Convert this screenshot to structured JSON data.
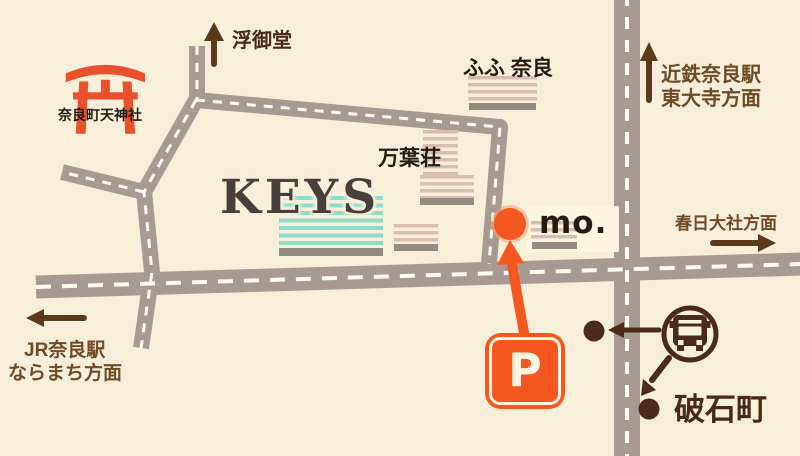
{
  "colors": {
    "background": "#f7efda",
    "road": "#a89a93",
    "road_dash": "#fffcf0",
    "accent_orange": "#f4571f",
    "orange_halo": "#f89e72",
    "torii_orange": "#e8512b",
    "teal_stripe": "#8fdbc8",
    "pink_stripe": "#d9bdb2",
    "building_base": "#948b81",
    "card": "#fcf5e2",
    "brown_text": "#6f4a26",
    "deep_brown": "#4a2a12",
    "arrow_brown": "#5b3a1c",
    "bus_brown": "#4a2b17",
    "dark_text": "#241a10",
    "keys_text": "#47403a",
    "cream": "#fdf3df"
  },
  "landmarks": {
    "shrine": {
      "label": "奈良町天神社",
      "icon": "torii-icon"
    },
    "ukimido": {
      "label": "浮御堂"
    },
    "fufu_nara": {
      "label": "ふふ 奈良"
    },
    "manyoso": {
      "label": "万葉荘"
    },
    "keys": {
      "label": "KEYS"
    },
    "mo": {
      "label": "mo.",
      "icon": "location-dot-icon"
    },
    "parking": {
      "label": "P",
      "icon": "parking-icon"
    },
    "bus_stop": {
      "label": "破石町",
      "icon": "bus-icon"
    }
  },
  "directions": {
    "ukimido_arrow": "up",
    "kintetsu": {
      "line1": "近鉄奈良駅",
      "line2": "東大寺方面",
      "arrow": "up"
    },
    "kasuga": {
      "label": "春日大社方面",
      "arrow": "right"
    },
    "jr_nara": {
      "line1": "JR奈良駅",
      "line2": "ならまち方面",
      "arrow": "left"
    }
  }
}
